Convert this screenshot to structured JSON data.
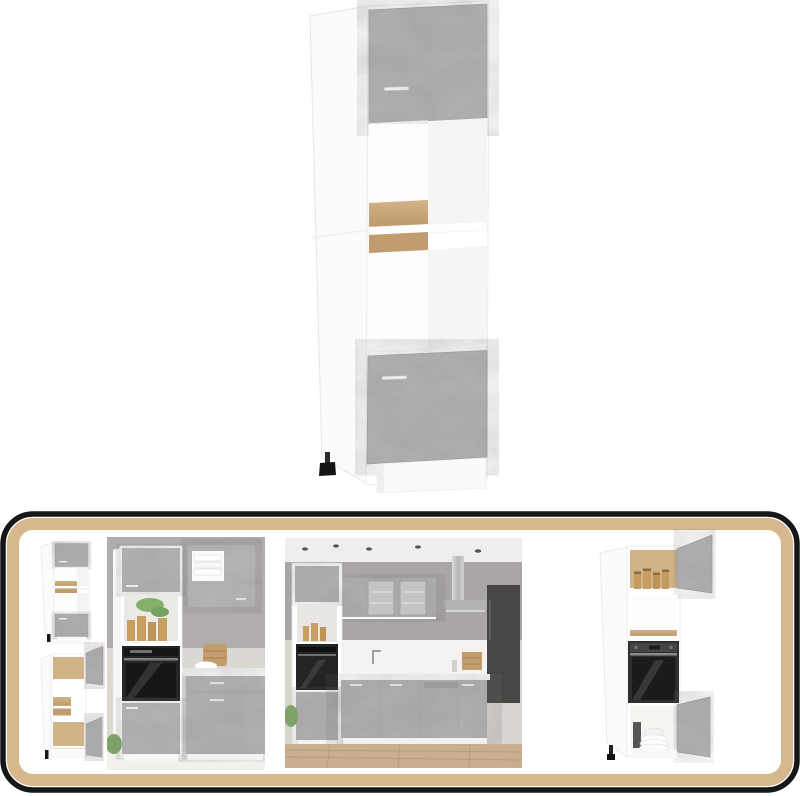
{
  "page": {
    "type": "furniture-product-listing-image",
    "background": "#ffffff"
  },
  "colors": {
    "concrete": "#b4b4b4",
    "concrete_light": "#bcbcbc",
    "concrete_edge": "#9e9e9e",
    "oak": "#cbaa7d",
    "oak_dark": "#c09c6e",
    "oak_back": "#d2b287",
    "carcass_white": "#ffffff",
    "carcass_side": "#fbfbfb",
    "carcass_inner": "#f5f5f4",
    "frame_black": "#161616",
    "frame_tan": "#d7b88e",
    "wall_gray": "#b0adac",
    "wall_light": "#dbd8d4",
    "ceiling": "#efeeec",
    "floor_wood": "#c8af90",
    "floor_line": "#b49b7d",
    "appliance_black": "#262626",
    "oven_glass": "#161616",
    "steel": "#c6c6c6",
    "dark_unit": "#474645",
    "handle_silver": "#ececec",
    "jar_amber": "#c89e63",
    "plant_green": "#85b06c",
    "basket_tan": "#c29d6f",
    "foot_black": "#141414"
  },
  "gallery": {
    "main": {
      "id": "main-cabinet-render",
      "kind": "tall-microwave-cabinet-concrete-grey-closed"
    },
    "frame": {
      "outer_border": "#161616",
      "inner_border": "#d7b88e",
      "corner_radius": 30
    },
    "thumbnails": [
      {
        "id": "thumb-cabinet-closed-small",
        "kind": "cabinet-front-closed"
      },
      {
        "id": "thumb-cabinet-open-small",
        "kind": "cabinet-doors-open"
      },
      {
        "id": "thumb-kitchen-cabinet-oven",
        "kind": "cabinet-in-kitchen-with-oven"
      },
      {
        "id": "thumb-kitchen-scene",
        "kind": "full-kitchen-scene"
      },
      {
        "id": "thumb-cabinet-open-large",
        "kind": "cabinet-open-with-oven-and-dishes"
      }
    ]
  }
}
